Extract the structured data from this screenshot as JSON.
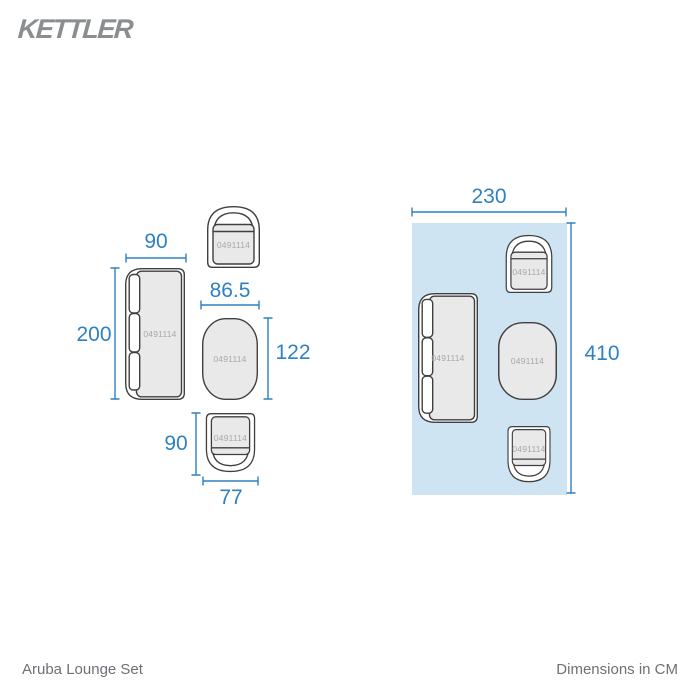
{
  "brand": "KETTLER",
  "product_code": "0491114",
  "footer": {
    "product_name": "Aruba Lounge Set",
    "units_note": "Dimensions in CM"
  },
  "colors": {
    "dimension_blue": "#2f81c3",
    "plan_fill": "#cfe4f3",
    "furniture_fill": "#e9e9e9",
    "outline": "#3f3f3f",
    "code_label": "#a8a8a8",
    "logo_gray": "#8b8e90",
    "footer_gray": "#6c7176"
  },
  "left_diagram": {
    "sofa": {
      "width": "90",
      "length": "200"
    },
    "table": {
      "width": "86.5",
      "length": "122"
    },
    "armchair": {
      "depth": "90",
      "width": "77"
    }
  },
  "plan": {
    "width": "230",
    "length": "410"
  }
}
